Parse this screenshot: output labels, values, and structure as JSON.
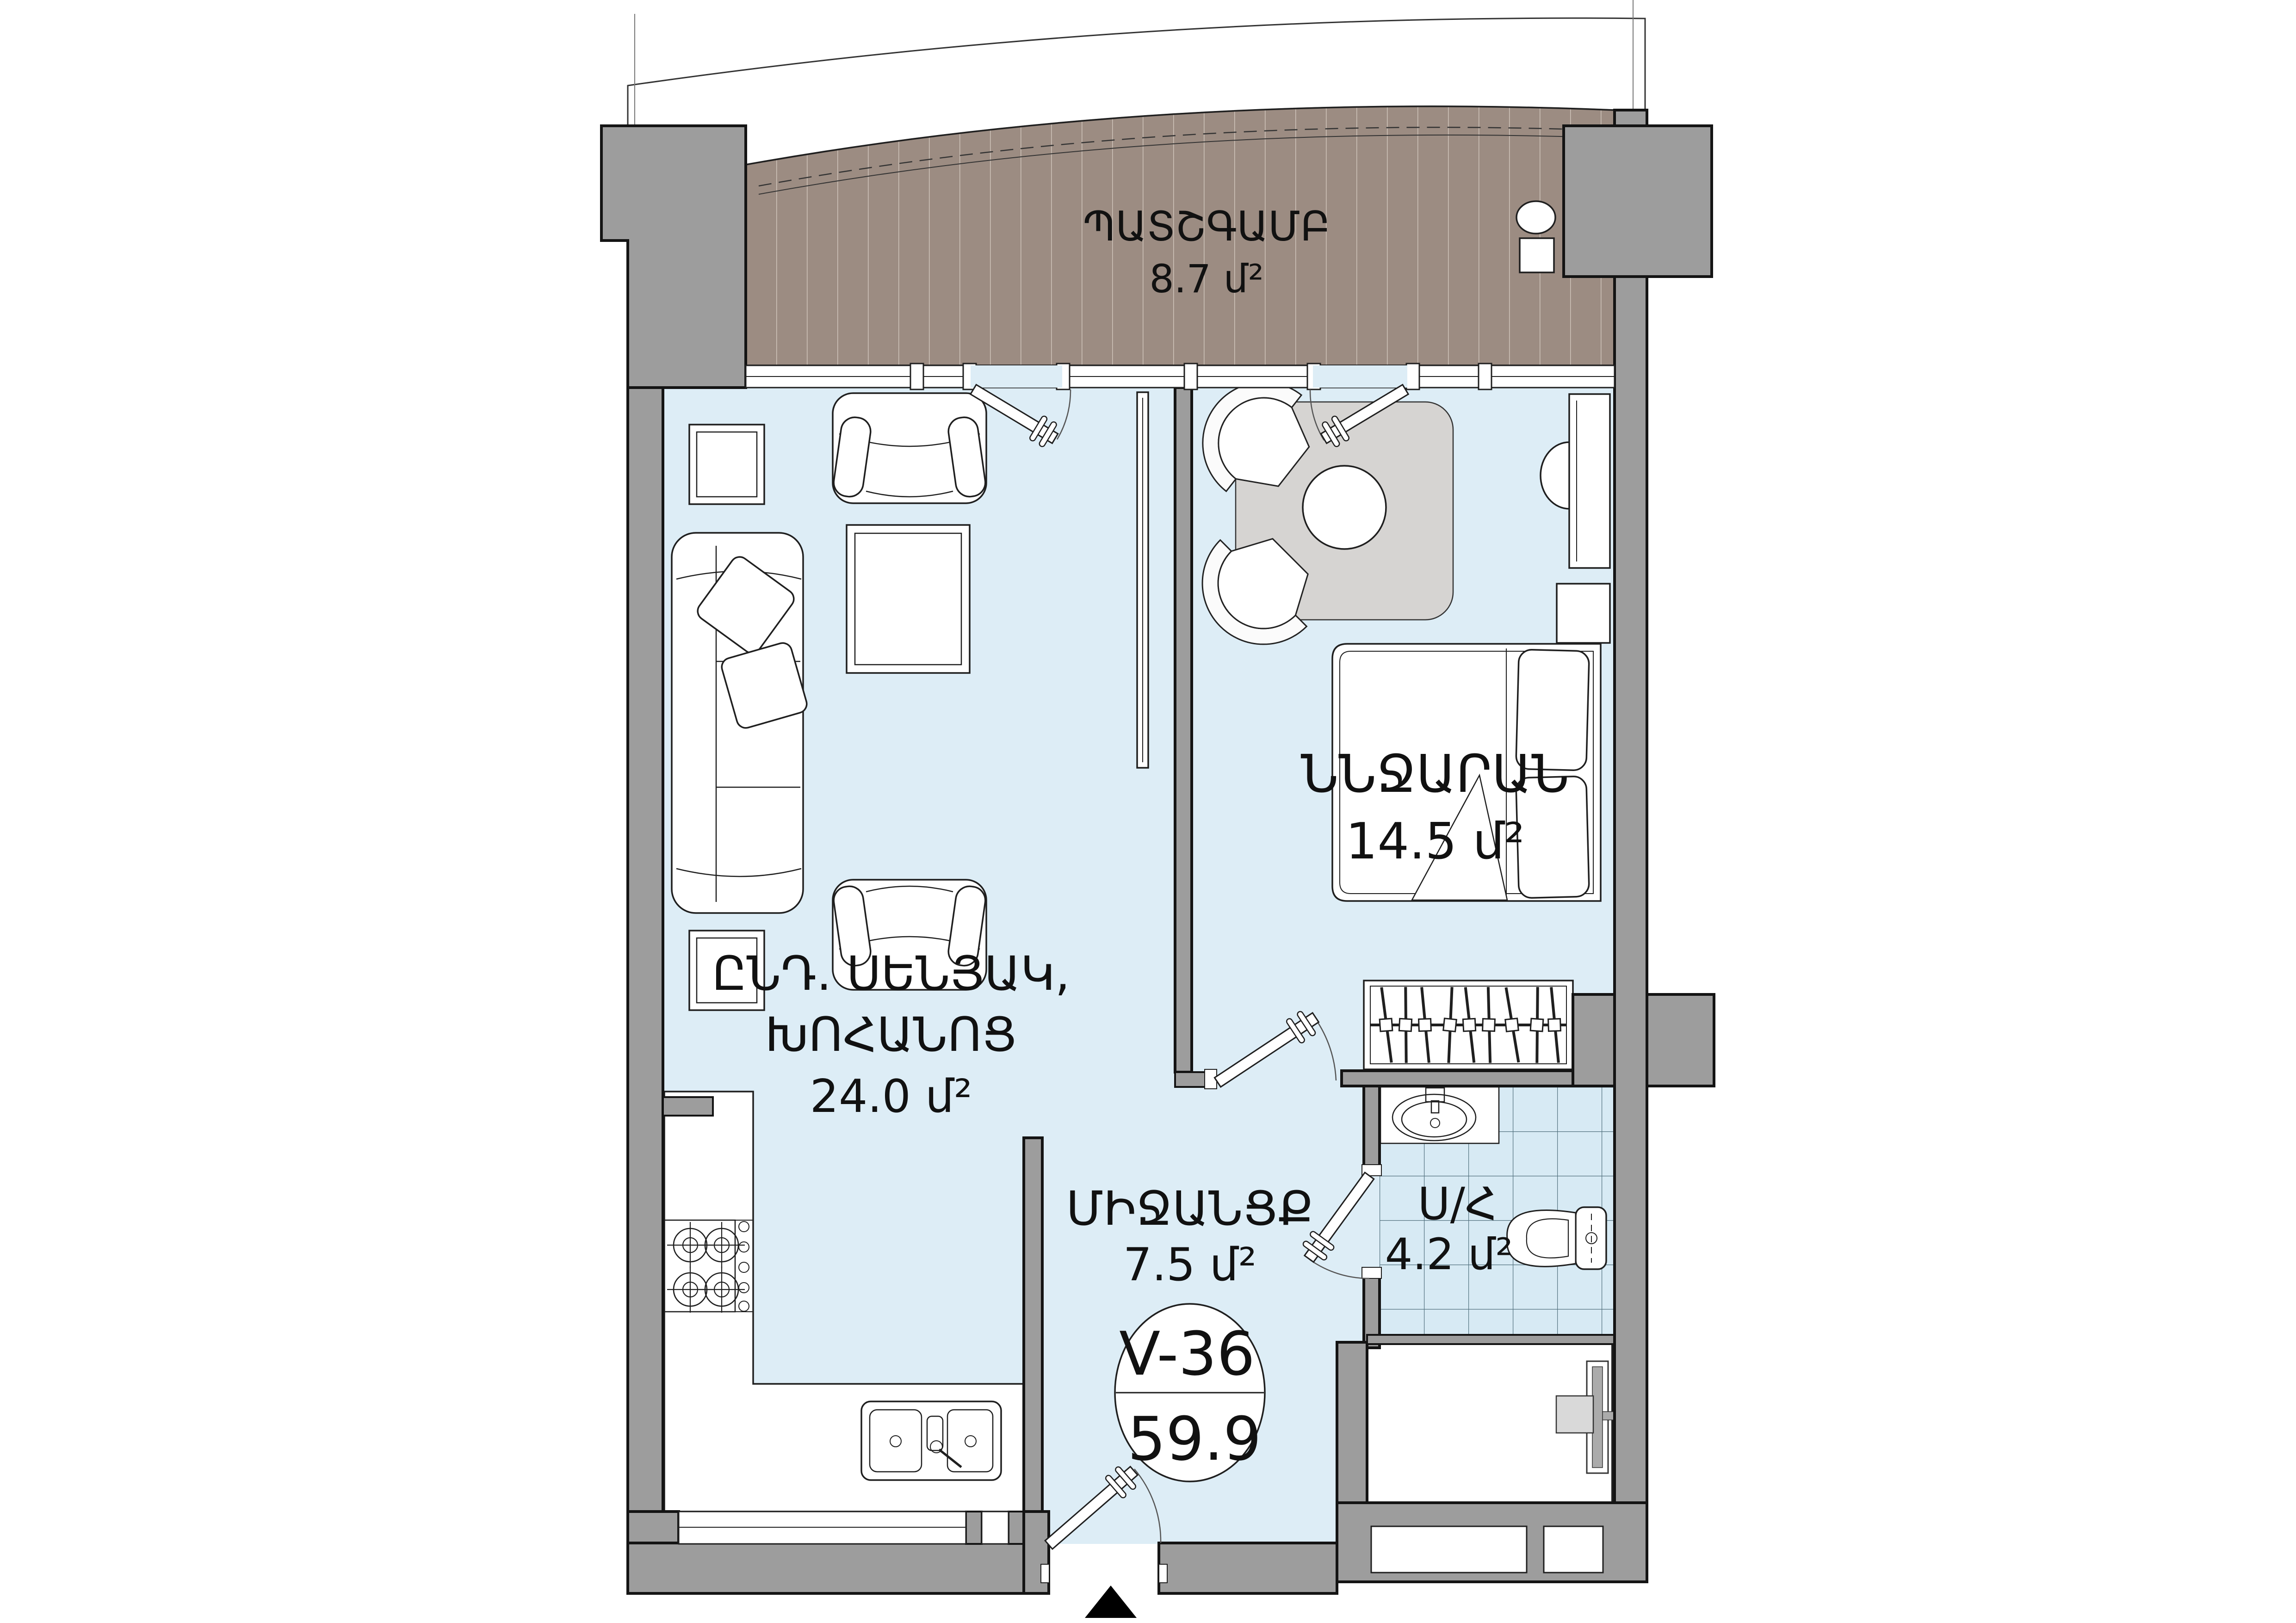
{
  "unit_badge": {
    "number": "V-36",
    "total_area": "59.9"
  },
  "rooms": {
    "balcony": {
      "name": "ՊԱՏՇԳԱՄԲ",
      "area": "8.7 մ²"
    },
    "living": {
      "name_line1": "ԸՆԴ. ՍԵՆՅԱԿ,",
      "name_line2": "ԽՈՀԱՆՈՑ",
      "area": "24.0 մ²"
    },
    "bedroom": {
      "name": "ՆՆՋԱՐԱՆ",
      "area": "14.5 մ²"
    },
    "hallway": {
      "name": "ՄԻՋԱՆՑՔ",
      "area": "7.5 մ²"
    },
    "bathroom": {
      "name": "Ս/Հ",
      "area": "4.2 մ²"
    }
  },
  "colors": {
    "wall": "#9d9d9d",
    "floor": "#ddedf6",
    "balcony_deck": "#9c8c82",
    "rug": "#d6d4d2",
    "tile_line": "#51707e",
    "outline": "#141414"
  }
}
